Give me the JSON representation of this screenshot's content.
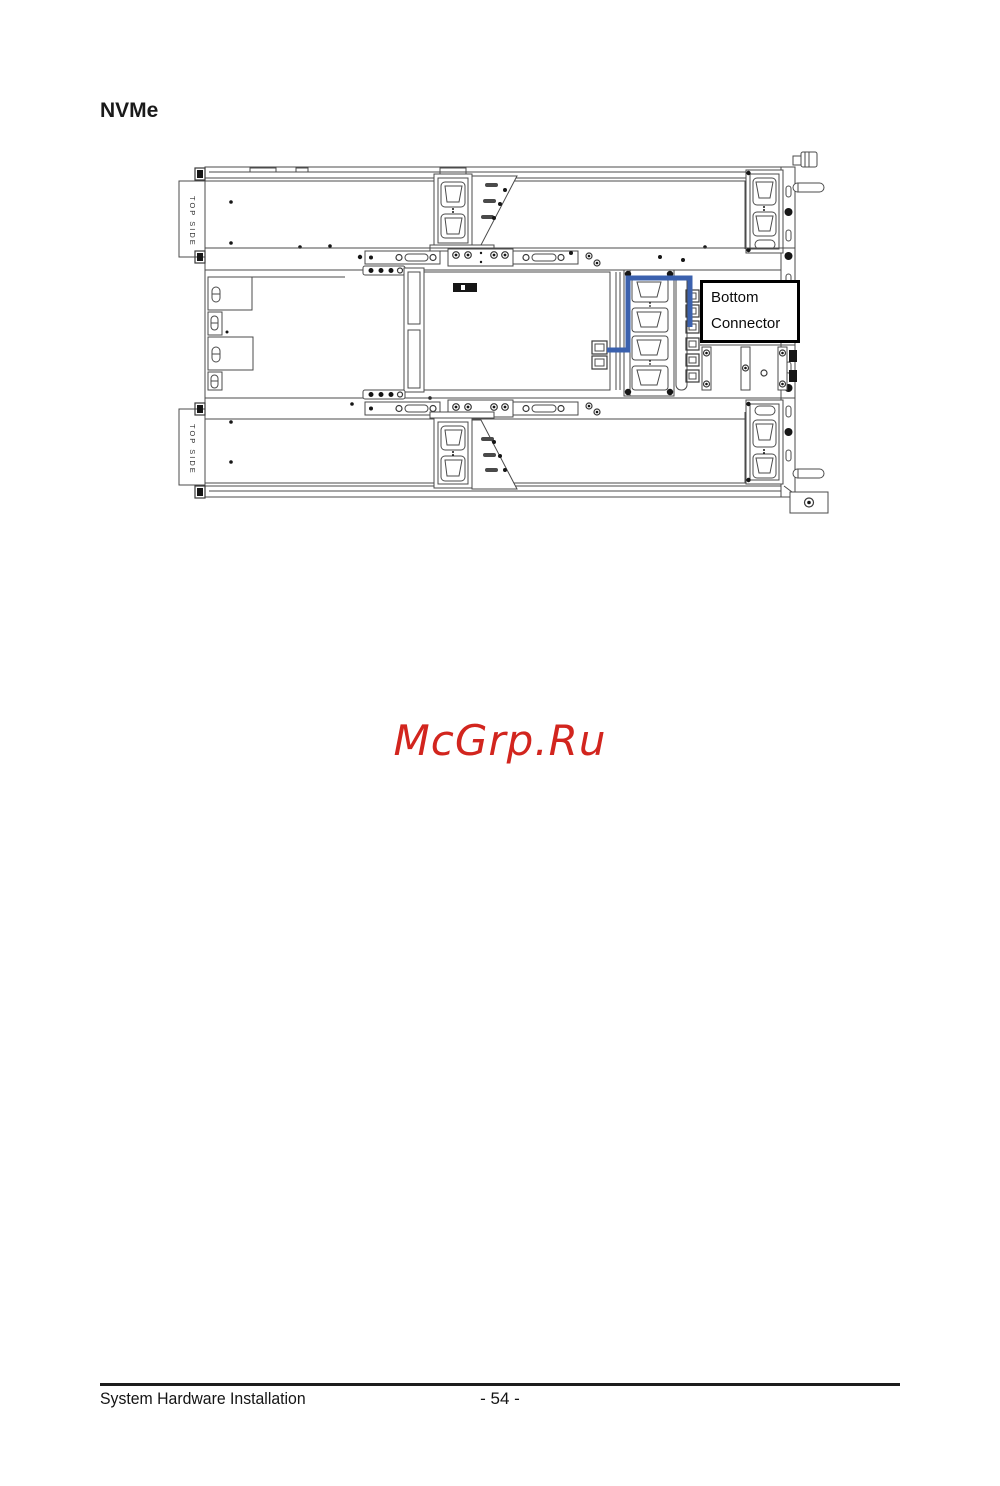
{
  "page": {
    "heading": "NVMe",
    "watermark": "McGrp.Ru",
    "footer": {
      "left_text": "System Hardware Installation",
      "page_number": "- 54 -"
    }
  },
  "diagram": {
    "description": "Server chassis top view with NVMe cable routing",
    "top_side_upper": "TOP SIDE",
    "top_side_lower": "TOP SIDE",
    "callout": {
      "line1": "Bottom",
      "line2": "Connector"
    },
    "colors": {
      "cable_blue": "#3b61ae",
      "watermark_red": "#d2251e",
      "callout_border": "#000000",
      "drawing_line": "#4b4b4b"
    }
  }
}
